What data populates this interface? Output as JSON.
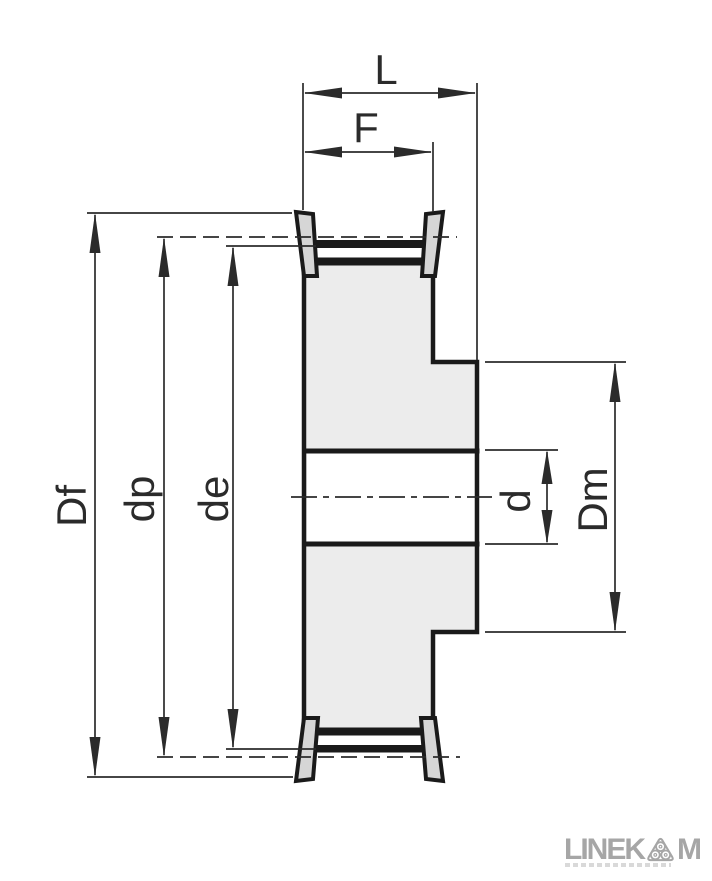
{
  "drawing": {
    "type": "pulley-cross-section",
    "description_labels": {
      "total_length": "L",
      "face_width": "F",
      "flange_diameter": "Df",
      "pitch_diameter": "dp",
      "outside_diameter": "de",
      "bore_diameter": "d",
      "hub_diameter": "Dm"
    }
  },
  "logo": {
    "brand_prefix": "LINEK",
    "brand_suffix": "M",
    "icon": "triple-pulley-o-icon"
  },
  "colors": {
    "outline": "#1a1a1a",
    "dimension": "#2b2b2b",
    "body-fill": "#ececec",
    "flange-fill": "#d6d6d6",
    "bore-fill": "#ffffff",
    "logo-gray": "#a6a6a6",
    "background": "#ffffff"
  }
}
